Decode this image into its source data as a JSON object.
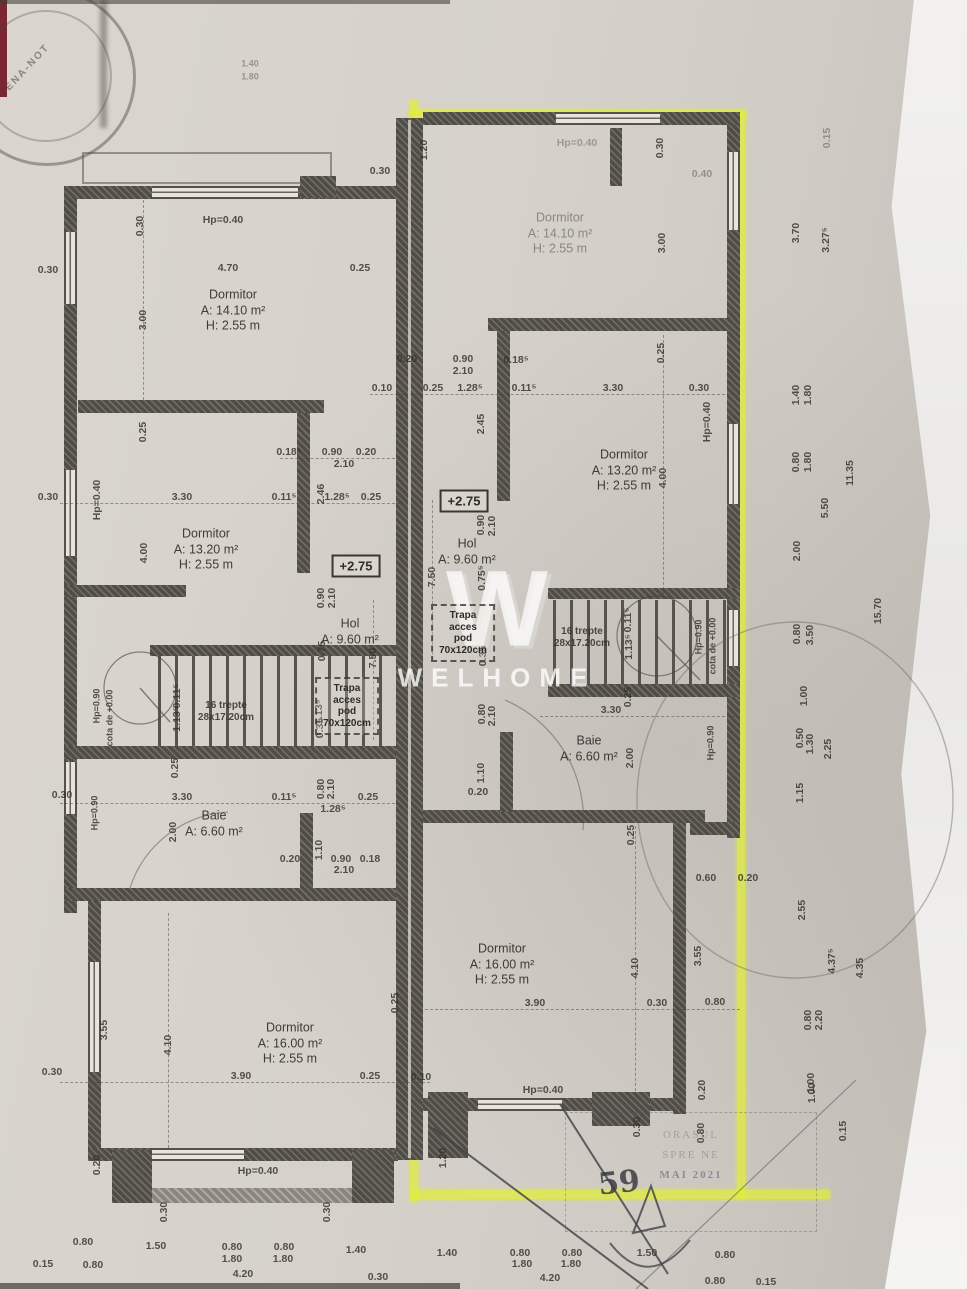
{
  "watermark": {
    "brand": "WELHOME",
    "logo": "W"
  },
  "stamps": {
    "notary_fragment": "ENA-NOT",
    "approval_stamp": {
      "line1": "ORASUL",
      "line2": "SPRE NE",
      "line3": "MAI 2021"
    },
    "handwritten": "59"
  },
  "highlight_color": "#e2ee37",
  "rooms": [
    {
      "name": "Dormitor",
      "area": "A: 14.10 m²",
      "height": "H: 2.55 m",
      "x": 233,
      "y": 311,
      "o": 0.9
    },
    {
      "name": "Dormitor",
      "area": "A: 14.10 m²",
      "height": "H: 2.55 m",
      "x": 560,
      "y": 234,
      "o": 0.45
    },
    {
      "name": "Dormitor",
      "area": "A: 13.20 m²",
      "height": "H: 2.55 m",
      "x": 206,
      "y": 550,
      "o": 0.9
    },
    {
      "name": "Dormitor",
      "area": "A: 13.20 m²",
      "height": "H: 2.55 m",
      "x": 624,
      "y": 471,
      "o": 0.9
    },
    {
      "name": "Hol",
      "area": "A: 9.60 m²",
      "x": 350,
      "y": 632,
      "o": 0.9
    },
    {
      "name": "Hol",
      "area": "A: 9.60 m²",
      "x": 467,
      "y": 552,
      "o": 0.9
    },
    {
      "name": "Baie",
      "area": "A: 6.60 m²",
      "x": 214,
      "y": 824,
      "o": 0.9
    },
    {
      "name": "Baie",
      "area": "A: 6.60 m²",
      "x": 589,
      "y": 749,
      "o": 0.9
    },
    {
      "name": "Dormitor",
      "area": "A: 16.00 m²",
      "height": "H: 2.55 m",
      "x": 290,
      "y": 1044,
      "o": 0.9
    },
    {
      "name": "Dormitor",
      "area": "A: 16.00 m²",
      "height": "H: 2.55 m",
      "x": 502,
      "y": 965,
      "o": 0.9
    }
  ],
  "stairs_labels": [
    {
      "line1": "16 trepte",
      "line2": "28x17.20cm",
      "x": 226,
      "y": 712
    },
    {
      "line1": "16 trepte",
      "line2": "28x17.20cm",
      "x": 582,
      "y": 638
    }
  ],
  "hatch_boxes": [
    {
      "l1": "Trapa",
      "l2": "acces",
      "l3": "pod",
      "l4": "70x120cm",
      "x": 347,
      "y": 706
    },
    {
      "l1": "Trapa",
      "l2": "acces",
      "l3": "pod",
      "l4": "70x120cm",
      "x": 463,
      "y": 633
    }
  ],
  "elevation_marks": [
    {
      "t": "+2.75",
      "x": 356,
      "y": 566
    },
    {
      "t": "+2.75",
      "x": 464,
      "y": 501
    }
  ],
  "dims": [
    {
      "t": "Hp=0.40",
      "x": 223,
      "y": 220
    },
    {
      "t": "4.70",
      "x": 228,
      "y": 268
    },
    {
      "t": "0.25",
      "x": 360,
      "y": 268
    },
    {
      "t": "3.00",
      "x": 143,
      "y": 320,
      "r": 1
    },
    {
      "t": "0.30",
      "x": 140,
      "y": 226,
      "r": 1
    },
    {
      "t": "0.30",
      "x": 48,
      "y": 270
    },
    {
      "t": "1.40",
      "x": 250,
      "y": 64,
      "o": 0.4,
      "s": 9
    },
    {
      "t": "1.80",
      "x": 250,
      "y": 77,
      "o": 0.4,
      "s": 9
    },
    {
      "t": "Hp=0.40",
      "x": 577,
      "y": 143,
      "o": 0.35
    },
    {
      "t": "0.30",
      "x": 660,
      "y": 148,
      "r": 1
    },
    {
      "t": "3.00",
      "x": 662,
      "y": 243,
      "r": 1
    },
    {
      "t": "0.40",
      "x": 702,
      "y": 174,
      "o": 0.4
    },
    {
      "t": "0.30",
      "x": 380,
      "y": 171
    },
    {
      "t": "1.20",
      "x": 424,
      "y": 150,
      "r": 1
    },
    {
      "t": "0.15",
      "x": 827,
      "y": 138,
      "r": 1,
      "o": 0.4
    },
    {
      "t": "3.70",
      "x": 796,
      "y": 233,
      "r": 1
    },
    {
      "t": "3.27⁵",
      "x": 826,
      "y": 240,
      "r": 1
    },
    {
      "t": "0.20",
      "x": 407,
      "y": 359
    },
    {
      "t": "0.90",
      "x": 463,
      "y": 359
    },
    {
      "t": "2.10",
      "x": 463,
      "y": 371
    },
    {
      "t": "0.18⁵",
      "x": 516,
      "y": 360
    },
    {
      "t": "0.10",
      "x": 382,
      "y": 388
    },
    {
      "t": "0.25",
      "x": 433,
      "y": 388
    },
    {
      "t": "1.28⁵",
      "x": 470,
      "y": 388
    },
    {
      "t": "0.11⁵",
      "x": 524,
      "y": 388
    },
    {
      "t": "3.30",
      "x": 613,
      "y": 388
    },
    {
      "t": "0.30",
      "x": 699,
      "y": 388
    },
    {
      "t": "0.25",
      "x": 661,
      "y": 353,
      "r": 1
    },
    {
      "t": "2.45",
      "x": 481,
      "y": 424,
      "r": 1
    },
    {
      "t": "Hp=0.40",
      "x": 707,
      "y": 422,
      "r": 1
    },
    {
      "t": "4.00",
      "x": 663,
      "y": 478,
      "r": 1
    },
    {
      "t": "0.90",
      "x": 481,
      "y": 525,
      "r": 1
    },
    {
      "t": "2.10",
      "x": 492,
      "y": 526,
      "r": 1
    },
    {
      "t": "7.50",
      "x": 432,
      "y": 577,
      "r": 1
    },
    {
      "t": "0.75⁵",
      "x": 482,
      "y": 578,
      "r": 1
    },
    {
      "t": "0.25",
      "x": 143,
      "y": 432,
      "r": 1
    },
    {
      "t": "Hp=0.40",
      "x": 97,
      "y": 500,
      "r": 1
    },
    {
      "t": "0.30",
      "x": 48,
      "y": 497
    },
    {
      "t": "3.30",
      "x": 182,
      "y": 497
    },
    {
      "t": "0.18⁵",
      "x": 289,
      "y": 452
    },
    {
      "t": "0.90",
      "x": 332,
      "y": 452
    },
    {
      "t": "0.20",
      "x": 366,
      "y": 452
    },
    {
      "t": "2.10",
      "x": 344,
      "y": 464
    },
    {
      "t": "0.11⁵",
      "x": 284,
      "y": 497
    },
    {
      "t": "2.46",
      "x": 321,
      "y": 494,
      "r": 1
    },
    {
      "t": "1.28⁵",
      "x": 337,
      "y": 497
    },
    {
      "t": "0.25",
      "x": 371,
      "y": 497
    },
    {
      "t": "4.00",
      "x": 144,
      "y": 553,
      "r": 1
    },
    {
      "t": "0.90",
      "x": 321,
      "y": 598,
      "r": 1
    },
    {
      "t": "2.10",
      "x": 332,
      "y": 598,
      "r": 1
    },
    {
      "t": "0.75",
      "x": 322,
      "y": 651,
      "r": 1
    },
    {
      "t": "7.50",
      "x": 373,
      "y": 658,
      "r": 1
    },
    {
      "t": "1.13⁵",
      "x": 319,
      "y": 712,
      "r": 1
    },
    {
      "t": "0.35",
      "x": 320,
      "y": 728,
      "r": 1
    },
    {
      "t": "0.11⁵",
      "x": 177,
      "y": 696,
      "r": 1
    },
    {
      "t": "1.13⁵",
      "x": 177,
      "y": 719,
      "r": 1
    },
    {
      "t": "0.25",
      "x": 175,
      "y": 768,
      "r": 1
    },
    {
      "t": "cota de +0.00",
      "x": 110,
      "y": 718,
      "r": 1,
      "s": 9
    },
    {
      "t": "Hp=0.90",
      "x": 97,
      "y": 706,
      "r": 1,
      "s": 9
    },
    {
      "t": "0.11⁵",
      "x": 628,
      "y": 620,
      "r": 1
    },
    {
      "t": "1.13⁵",
      "x": 629,
      "y": 647,
      "r": 1
    },
    {
      "t": "Hp=0.90",
      "x": 699,
      "y": 637,
      "r": 1,
      "s": 9
    },
    {
      "t": "cota de +0.00",
      "x": 713,
      "y": 646,
      "r": 1,
      "s": 9
    },
    {
      "t": "0.35",
      "x": 483,
      "y": 656,
      "r": 1
    },
    {
      "t": "0.80",
      "x": 482,
      "y": 714,
      "r": 1
    },
    {
      "t": "2.10",
      "x": 492,
      "y": 716,
      "r": 1
    },
    {
      "t": "0.25",
      "x": 628,
      "y": 697,
      "r": 1
    },
    {
      "t": "3.30",
      "x": 611,
      "y": 710
    },
    {
      "t": "2.00",
      "x": 630,
      "y": 758,
      "r": 1
    },
    {
      "t": "Hp=0.90",
      "x": 711,
      "y": 743,
      "r": 1,
      "s": 9
    },
    {
      "t": "1.10",
      "x": 481,
      "y": 773,
      "r": 1
    },
    {
      "t": "0.20",
      "x": 478,
      "y": 792
    },
    {
      "t": "0.25",
      "x": 631,
      "y": 835,
      "r": 1
    },
    {
      "t": "0.30",
      "x": 62,
      "y": 795
    },
    {
      "t": "Hp=0.90",
      "x": 95,
      "y": 813,
      "r": 1,
      "s": 9
    },
    {
      "t": "3.30",
      "x": 182,
      "y": 797
    },
    {
      "t": "2.00",
      "x": 173,
      "y": 832,
      "r": 1
    },
    {
      "t": "0.11⁵",
      "x": 284,
      "y": 797
    },
    {
      "t": "0.80",
      "x": 321,
      "y": 789,
      "r": 1
    },
    {
      "t": "2.10",
      "x": 331,
      "y": 789,
      "r": 1
    },
    {
      "t": "0.25",
      "x": 368,
      "y": 797
    },
    {
      "t": "1.28⁵",
      "x": 333,
      "y": 809
    },
    {
      "t": "0.20",
      "x": 290,
      "y": 859
    },
    {
      "t": "1.10",
      "x": 319,
      "y": 850,
      "r": 1
    },
    {
      "t": "0.90",
      "x": 341,
      "y": 859
    },
    {
      "t": "0.18",
      "x": 370,
      "y": 859
    },
    {
      "t": "2.10",
      "x": 344,
      "y": 870
    },
    {
      "t": "0.25",
      "x": 395,
      "y": 1003,
      "r": 1
    },
    {
      "t": "3.55",
      "x": 104,
      "y": 1030,
      "r": 1
    },
    {
      "t": "4.10",
      "x": 168,
      "y": 1045,
      "r": 1
    },
    {
      "t": "0.30",
      "x": 52,
      "y": 1072
    },
    {
      "t": "3.90",
      "x": 241,
      "y": 1076
    },
    {
      "t": "0.25",
      "x": 370,
      "y": 1076
    },
    {
      "t": "0.10",
      "x": 421,
      "y": 1077
    },
    {
      "t": "0.20",
      "x": 97,
      "y": 1165,
      "r": 1
    },
    {
      "t": "Hp=0.40",
      "x": 258,
      "y": 1171
    },
    {
      "t": "0.30",
      "x": 164,
      "y": 1212,
      "r": 1
    },
    {
      "t": "0.30",
      "x": 327,
      "y": 1212,
      "r": 1
    },
    {
      "t": "0.80",
      "x": 83,
      "y": 1242
    },
    {
      "t": "0.15",
      "x": 43,
      "y": 1264
    },
    {
      "t": "0.80",
      "x": 93,
      "y": 1265
    },
    {
      "t": "1.50",
      "x": 156,
      "y": 1246
    },
    {
      "t": "0.80",
      "x": 232,
      "y": 1247
    },
    {
      "t": "1.80",
      "x": 232,
      "y": 1259
    },
    {
      "t": "0.80",
      "x": 284,
      "y": 1247
    },
    {
      "t": "1.80",
      "x": 283,
      "y": 1259
    },
    {
      "t": "4.20",
      "x": 243,
      "y": 1274
    },
    {
      "t": "1.40",
      "x": 356,
      "y": 1250
    },
    {
      "t": "0.30",
      "x": 378,
      "y": 1277
    },
    {
      "t": "1.40",
      "x": 447,
      "y": 1253
    },
    {
      "t": "1.20",
      "x": 443,
      "y": 1158,
      "r": 1
    },
    {
      "t": "0.60",
      "x": 706,
      "y": 878
    },
    {
      "t": "0.20",
      "x": 748,
      "y": 878
    },
    {
      "t": "3.55",
      "x": 698,
      "y": 956,
      "r": 1
    },
    {
      "t": "4.10",
      "x": 635,
      "y": 968,
      "r": 1
    },
    {
      "t": "3.90",
      "x": 535,
      "y": 1003
    },
    {
      "t": "0.30",
      "x": 657,
      "y": 1003
    },
    {
      "t": "0.80",
      "x": 715,
      "y": 1002
    },
    {
      "t": "Hp=0.40",
      "x": 543,
      "y": 1090
    },
    {
      "t": "0.30",
      "x": 637,
      "y": 1127,
      "r": 1
    },
    {
      "t": "0.20",
      "x": 702,
      "y": 1090,
      "r": 1
    },
    {
      "t": "0.80",
      "x": 701,
      "y": 1133,
      "r": 1
    },
    {
      "t": "0.80",
      "x": 520,
      "y": 1253
    },
    {
      "t": "1.80",
      "x": 522,
      "y": 1264
    },
    {
      "t": "0.80",
      "x": 572,
      "y": 1253
    },
    {
      "t": "1.80",
      "x": 571,
      "y": 1264
    },
    {
      "t": "4.20",
      "x": 550,
      "y": 1278
    },
    {
      "t": "1.50",
      "x": 647,
      "y": 1253
    },
    {
      "t": "0.80",
      "x": 725,
      "y": 1255
    },
    {
      "t": "0.80",
      "x": 715,
      "y": 1281
    },
    {
      "t": "0.15",
      "x": 766,
      "y": 1282
    },
    {
      "t": "1.00",
      "x": 812,
      "y": 1093,
      "r": 1
    },
    {
      "t": "1.40",
      "x": 796,
      "y": 395,
      "r": 1
    },
    {
      "t": "1.80",
      "x": 808,
      "y": 395,
      "r": 1
    },
    {
      "t": "0.80",
      "x": 796,
      "y": 462,
      "r": 1
    },
    {
      "t": "1.80",
      "x": 808,
      "y": 462,
      "r": 1
    },
    {
      "t": "11.35",
      "x": 850,
      "y": 473,
      "r": 1
    },
    {
      "t": "5.50",
      "x": 825,
      "y": 508,
      "r": 1
    },
    {
      "t": "2.00",
      "x": 797,
      "y": 551,
      "r": 1
    },
    {
      "t": "15.70",
      "x": 878,
      "y": 611,
      "r": 1
    },
    {
      "t": "0.80",
      "x": 797,
      "y": 634,
      "r": 1
    },
    {
      "t": "3.50",
      "x": 810,
      "y": 635,
      "r": 1
    },
    {
      "t": "1.00",
      "x": 804,
      "y": 696,
      "r": 1
    },
    {
      "t": "0.50",
      "x": 800,
      "y": 738,
      "r": 1
    },
    {
      "t": "1.30",
      "x": 810,
      "y": 744,
      "r": 1
    },
    {
      "t": "2.25",
      "x": 828,
      "y": 749,
      "r": 1
    },
    {
      "t": "1.15",
      "x": 800,
      "y": 793,
      "r": 1
    },
    {
      "t": "2.55",
      "x": 802,
      "y": 910,
      "r": 1
    },
    {
      "t": "4.37⁵",
      "x": 832,
      "y": 961,
      "r": 1
    },
    {
      "t": "4.35",
      "x": 860,
      "y": 968,
      "r": 1
    },
    {
      "t": "0.80",
      "x": 808,
      "y": 1020,
      "r": 1
    },
    {
      "t": "2.20",
      "x": 819,
      "y": 1020,
      "r": 1
    },
    {
      "t": "1.00",
      "x": 811,
      "y": 1083,
      "r": 1
    },
    {
      "t": "0.15",
      "x": 843,
      "y": 1131,
      "r": 1
    }
  ]
}
